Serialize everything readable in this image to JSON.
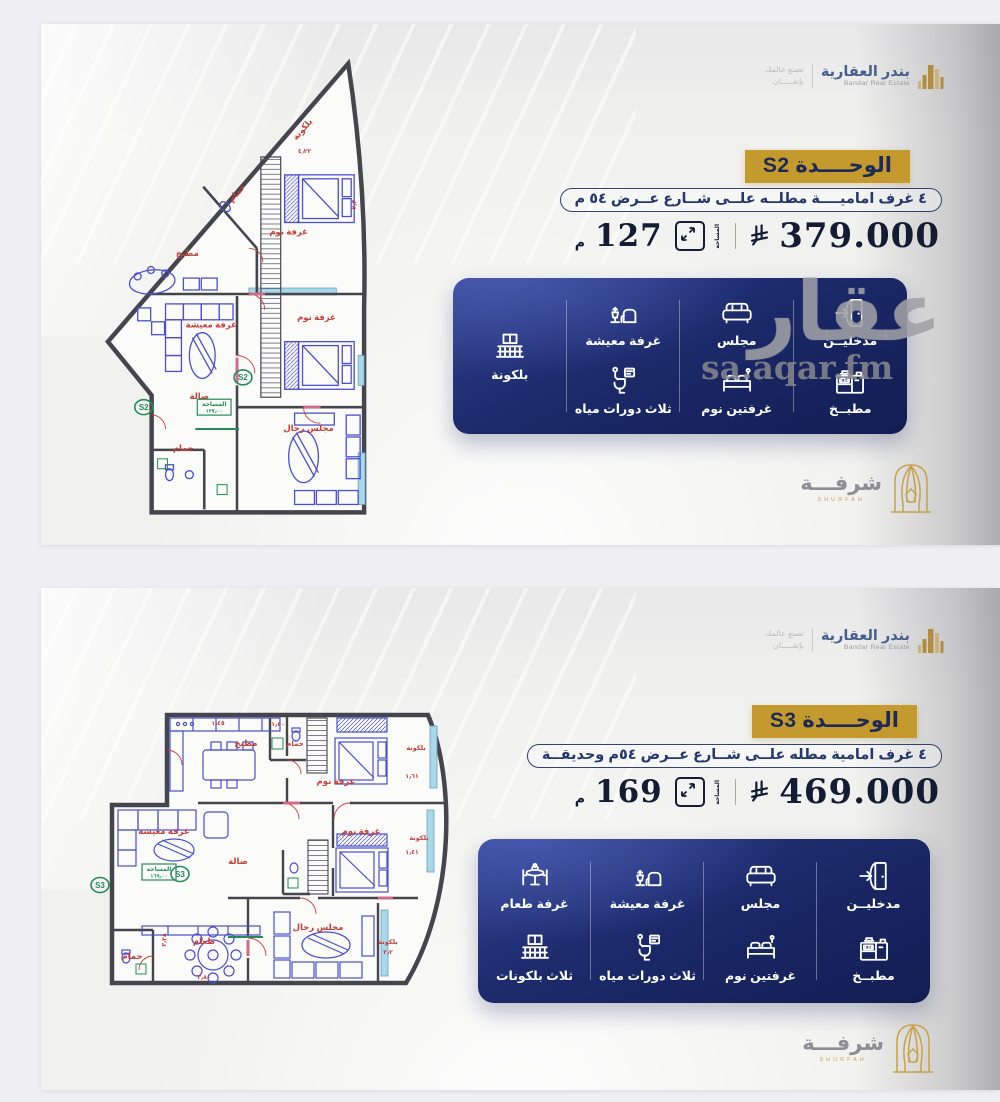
{
  "page": {
    "background": "#f0eff4"
  },
  "brand": {
    "name_ar": "بندر العقارية",
    "name_en": "Bandar Real Estate",
    "tagline_1": "نصنع عالمك",
    "tagline_2": "بإتقـــــان"
  },
  "shurfah": {
    "name_ar": "شرفـــة",
    "name_en": "SHURFAH"
  },
  "watermark": {
    "big": "عقار",
    "small": "sa.aqar.fm"
  },
  "colors": {
    "gold": "#c49a2f",
    "card_navy": "#1c2a6b",
    "plan_blue": "#4a4fd0",
    "plan_red": "#c4403a",
    "plan_green": "#238b57",
    "window_cyan": "#a8d8ea"
  },
  "panels": [
    {
      "unit": "S2",
      "banner": "الوحــــدة S2",
      "description": "٤ غرف اماميــــة مطلــه علــى شــارع عــرض ٥٤ م",
      "price": "379.000",
      "currency_icon": "saudi-riyal",
      "area_value": "127",
      "area_unit": "م",
      "area_caption": "المساحة",
      "features": [
        {
          "items": [
            {
              "icon": "door-entry",
              "label": "مدخليــن"
            },
            {
              "icon": "kitchen",
              "label": "مطبــخ"
            }
          ]
        },
        {
          "items": [
            {
              "icon": "sofa",
              "label": "مجلس"
            },
            {
              "icon": "bed",
              "label": "غرفتين نوم"
            }
          ]
        },
        {
          "items": [
            {
              "icon": "living",
              "label": "غرفة معيشة"
            },
            {
              "icon": "toilet",
              "label": "ثلاث دورات مياه"
            }
          ]
        },
        {
          "items": [
            {
              "icon": "balcony",
              "label": "بلكونة"
            }
          ]
        }
      ],
      "plan": {
        "badge": "S2",
        "badges": [
          {
            "x": 44,
            "y": 352
          },
          {
            "x": 144,
            "y": 322
          }
        ],
        "area_box": {
          "x": 98,
          "y": 344,
          "w": 34,
          "h": 16,
          "line1": "المساحة",
          "line2": "١٢٧٫٠٠"
        },
        "labels": [
          {
            "t": "بلكونة",
            "x": 206,
            "y": 74,
            "r": -49
          },
          {
            "t": "٤٫٢٢",
            "x": 206,
            "y": 96,
            "s": 6
          },
          {
            "t": "حمام",
            "x": 140,
            "y": 138,
            "r": -49
          },
          {
            "t": "غرفة نوم",
            "x": 190,
            "y": 178
          },
          {
            "t": "مطبخ",
            "x": 88,
            "y": 200
          },
          {
            "t": "٢٫٣",
            "x": 258,
            "y": 148,
            "r": -90,
            "s": 6
          },
          {
            "t": "غرفة نوم",
            "x": 218,
            "y": 264
          },
          {
            "t": "غرفة معيشة",
            "x": 112,
            "y": 272
          },
          {
            "t": "صالة",
            "x": 100,
            "y": 344
          },
          {
            "t": "مجلس رجال",
            "x": 210,
            "y": 376
          },
          {
            "t": "حمام",
            "x": 84,
            "y": 396
          }
        ]
      }
    },
    {
      "unit": "S3",
      "banner": "الوحــــدة S3",
      "description": "٤ غرف امامية مطله علــى شــارع عــرض ٥٤م وحديقــة",
      "price": "469.000",
      "currency_icon": "saudi-riyal",
      "area_value": "169",
      "area_unit": "م",
      "area_caption": "المساحة",
      "features": [
        {
          "items": [
            {
              "icon": "door-entry",
              "label": "مدخليــن"
            },
            {
              "icon": "kitchen",
              "label": "مطبــخ"
            }
          ]
        },
        {
          "items": [
            {
              "icon": "sofa",
              "label": "مجلس"
            },
            {
              "icon": "bed",
              "label": "غرفتين نوم"
            }
          ]
        },
        {
          "items": [
            {
              "icon": "living",
              "label": "غرفة معيشة"
            },
            {
              "icon": "toilet",
              "label": "ثلاث دورات مياه"
            }
          ]
        },
        {
          "items": [
            {
              "icon": "dining",
              "label": "غرفة طعام"
            },
            {
              "icon": "balcony",
              "label": "ثلاث بلكونات"
            }
          ]
        }
      ],
      "plan": {
        "badge": "S3",
        "badges": [
          {
            "x": 102,
            "y": 176
          },
          {
            "x": 22,
            "y": 187
          }
        ],
        "area_box": {
          "x": 64,
          "y": 166,
          "w": 34,
          "h": 16,
          "line1": "المساحة",
          "line2": "١٦٩٫٠٠"
        },
        "labels": [
          {
            "t": "مطبخ",
            "x": 168,
            "y": 48
          },
          {
            "t": "١٫٤٥",
            "x": 140,
            "y": 27,
            "s": 6
          },
          {
            "t": "حمام",
            "x": 217,
            "y": 48,
            "s": 7
          },
          {
            "t": "١٫٤٠",
            "x": 200,
            "y": 28,
            "s": 6
          },
          {
            "t": "غرفة نوم",
            "x": 258,
            "y": 86
          },
          {
            "t": "بلكونة",
            "x": 338,
            "y": 52,
            "s": 6.5
          },
          {
            "t": "١٫٦١",
            "x": 334,
            "y": 80,
            "s": 6
          },
          {
            "t": "غرفة معيشة",
            "x": 86,
            "y": 136
          },
          {
            "t": "صالة",
            "x": 160,
            "y": 166
          },
          {
            "t": "غرفة نوم",
            "x": 283,
            "y": 136
          },
          {
            "t": "بلكونة",
            "x": 341,
            "y": 142,
            "s": 6.5
          },
          {
            "t": "١٫٤١",
            "x": 334,
            "y": 156,
            "s": 6
          },
          {
            "t": "طعام",
            "x": 126,
            "y": 246
          },
          {
            "t": "مجلس رجال",
            "x": 240,
            "y": 232
          },
          {
            "t": "حمام",
            "x": 54,
            "y": 261
          },
          {
            "t": "بلكونة",
            "x": 310,
            "y": 246,
            "s": 6.5
          },
          {
            "t": "٢٫٢",
            "x": 310,
            "y": 256,
            "s": 6
          },
          {
            "t": "٣٫٨٠",
            "x": 126,
            "y": 281,
            "s": 6
          },
          {
            "t": "٣٫٢٨",
            "x": 88,
            "y": 242,
            "r": -90,
            "s": 6
          }
        ]
      }
    }
  ]
}
